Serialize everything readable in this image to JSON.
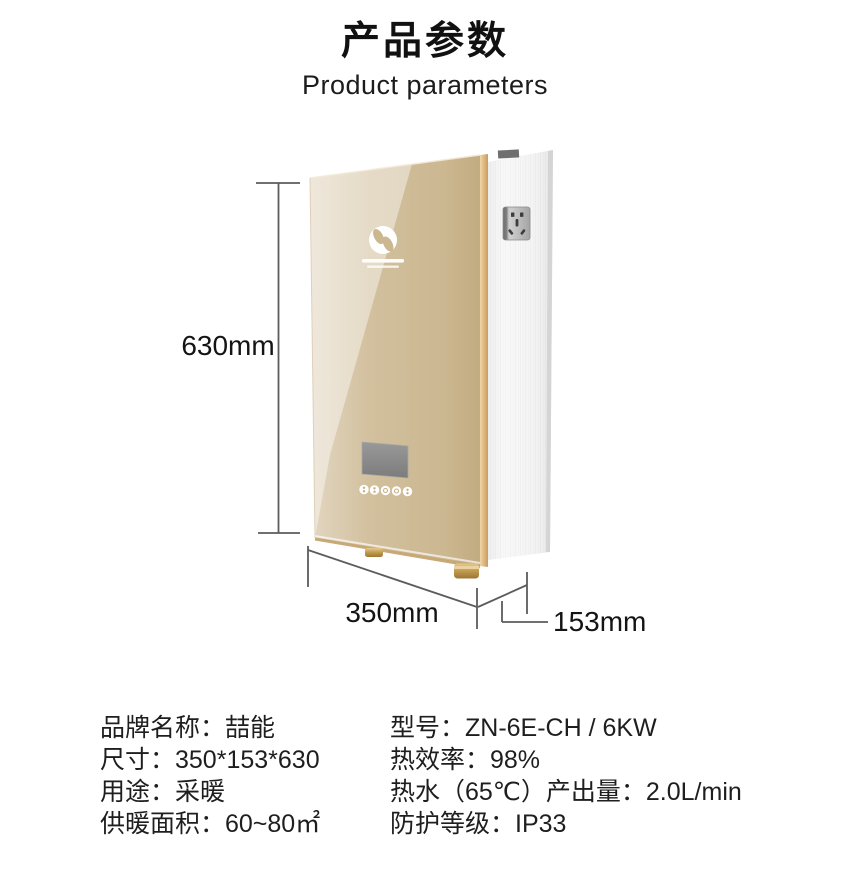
{
  "header": {
    "title_zh": "产品参数",
    "title_en": "Product parameters"
  },
  "dimensions": {
    "height": "630mm",
    "width": "350mm",
    "depth": "153mm"
  },
  "specs": {
    "left_rows": [
      "品牌名称：喆能",
      "尺寸：350*153*630",
      "用途：采暖",
      "供暖面积：60~80㎡"
    ],
    "right_rows": [
      "型号：ZN-6E-CH / 6KW",
      "热效率：98%",
      "热水（65℃）产出量：2.0L/min",
      "防护等级：IP33"
    ]
  },
  "colors": {
    "panel_gold_light": "#ebe1d0",
    "panel_gold": "#cdb996",
    "panel_gold_dark": "#c2ab81",
    "edge_gold": "#d9b274",
    "side_metal": "#f4f4f4",
    "pipe_gold": "#c09a4e",
    "display_gray": "#8d8d8d",
    "dimension_line": "#5c5c5c",
    "text": "#1a1a1a"
  }
}
